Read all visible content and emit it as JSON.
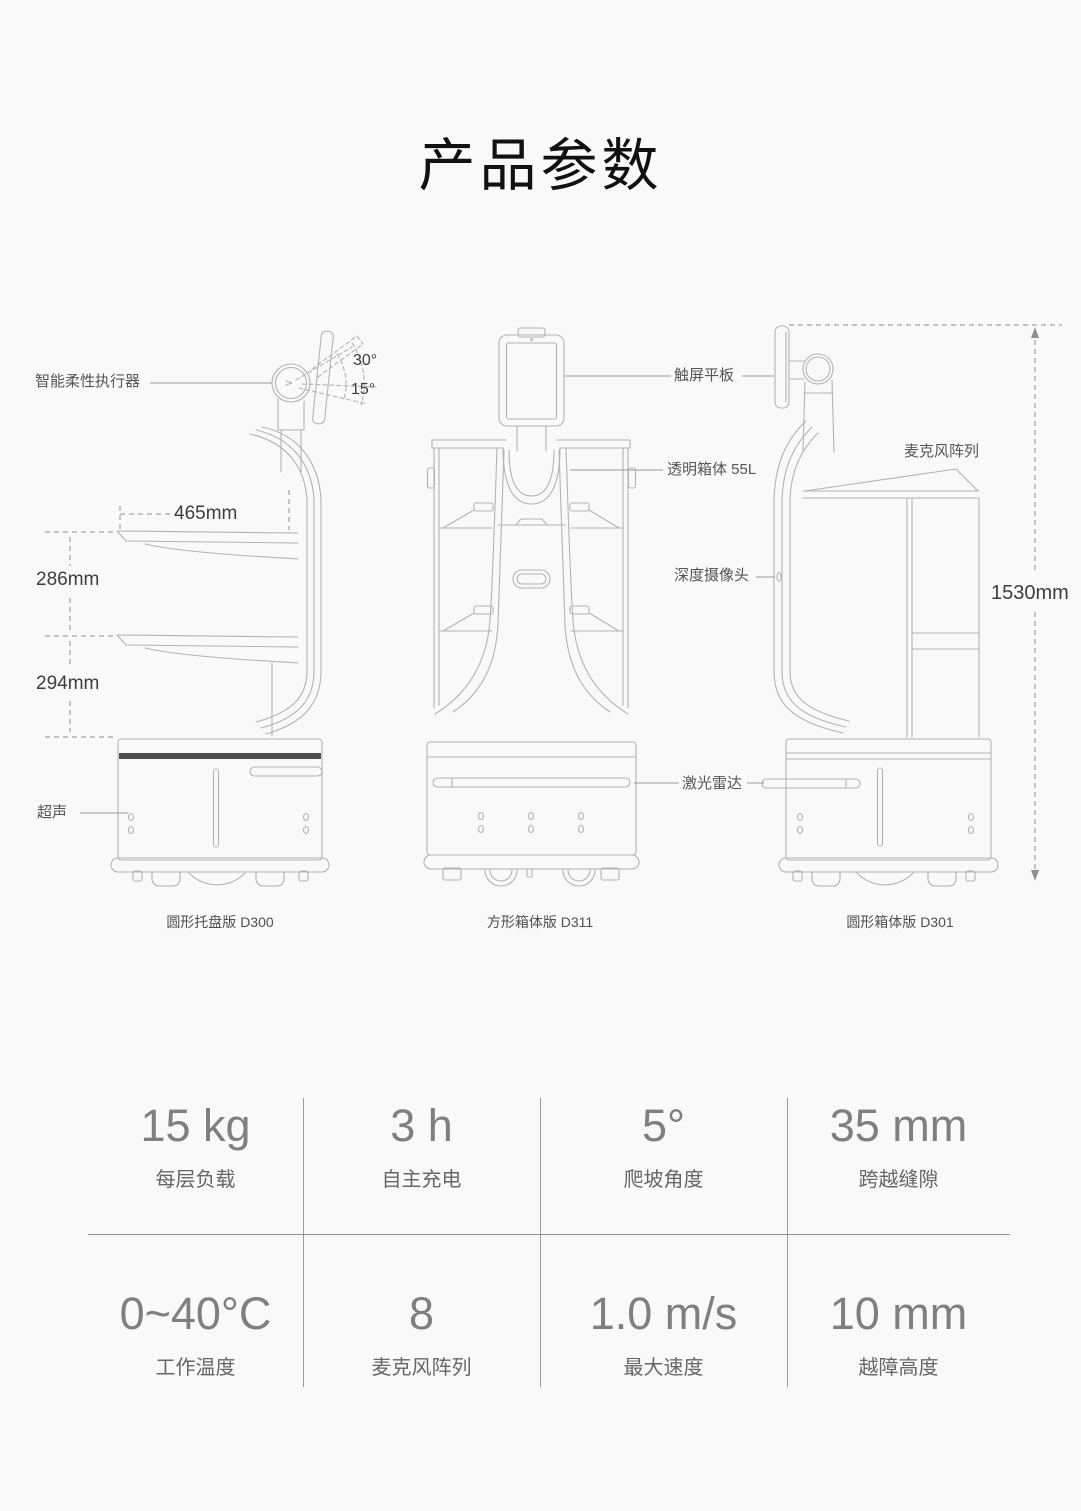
{
  "title": "产品参数",
  "diagram": {
    "labels": {
      "actuator": "智能柔性执行器",
      "angle_up": "30°",
      "angle_down": "15°",
      "tray_width": "465mm",
      "gap_upper": "286mm",
      "gap_lower": "294mm",
      "ultrasonic": "超声",
      "touchscreen": "触屏平板",
      "transparent_box": "透明箱体 55L",
      "depth_camera": "深度摄像头",
      "lidar": "激光雷达",
      "mic_array": "麦克风阵列",
      "total_height": "1530mm"
    },
    "captions": {
      "d300": "圆形托盘版 D300",
      "d311": "方形箱体版 D311",
      "d301": "圆形箱体版 D301"
    }
  },
  "specs": {
    "items": [
      {
        "value": "15 kg",
        "label": "每层负载"
      },
      {
        "value": "3 h",
        "label": "自主充电"
      },
      {
        "value": "5°",
        "label": "爬坡角度"
      },
      {
        "value": "35 mm",
        "label": "跨越缝隙"
      },
      {
        "value": "0~40°C",
        "label": "工作温度"
      },
      {
        "value": "8",
        "label": "麦克风阵列"
      },
      {
        "value": "1.0 m/s",
        "label": "最大速度"
      },
      {
        "value": "10 mm",
        "label": "越障高度"
      }
    ]
  },
  "colors": {
    "background": "#f9f9f9",
    "title_text": "#111111",
    "line_art": "#b3b3b3",
    "dark_band": "#4c4c4c",
    "annotation_text": "#555555",
    "dimension_text": "#3d3d3d",
    "spec_value_text": "#7f7f7f",
    "spec_label_text": "#666666",
    "divider": "#999999"
  }
}
